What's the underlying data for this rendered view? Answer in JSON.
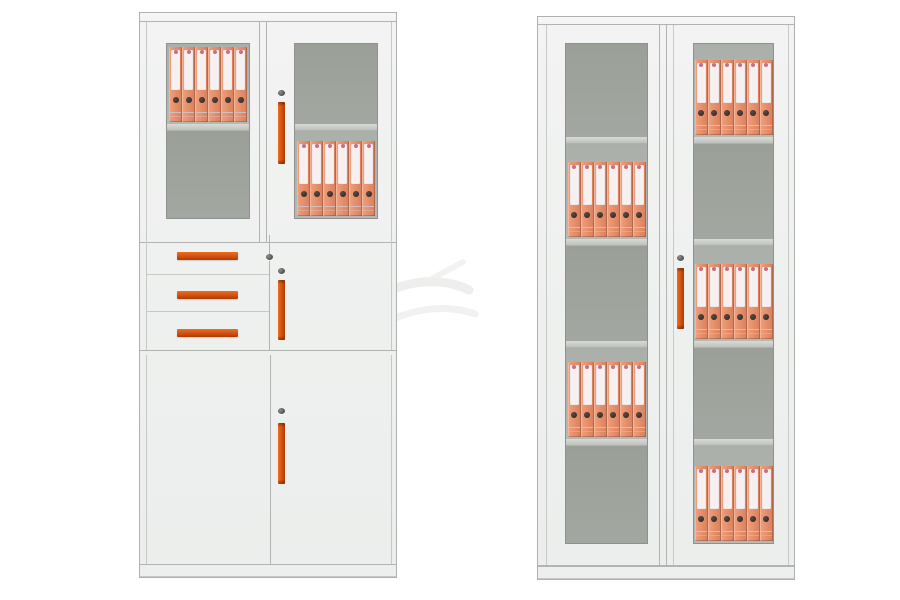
{
  "page": {
    "background": "#ffffff",
    "description_visible_text": ""
  },
  "colors": {
    "bg": "#ffffff",
    "body": "#ebeeec",
    "body_light": "#f2f3f2",
    "outer_edge": "#aeb1af",
    "frame_line": "#c7c9c8",
    "frame_dark": "#b2b4b3",
    "plinth": "#edefee",
    "glass_edge": "#8f918f",
    "glass_empty": "#a3a7a1",
    "glass_empty_top": "#9aa098",
    "glass_filled": "#b6b9b3",
    "glass_filled_top": "#abafa9",
    "shelf_light": "#d8dad6",
    "shelf_dark": "#bec1bc",
    "handle": "#d14d0b",
    "handle_hi": "#ec6d1f",
    "handle_lo": "#a83d06",
    "lock": "#484848",
    "binder_spine": "#e58d69",
    "binder_hi": "#f0a07d",
    "binder_lo": "#d87e5b",
    "binder_label": "#f7f0f0",
    "binder_dot": "#c76f86",
    "binder_text": "#cfbfc1",
    "binder_hole": "#362d29",
    "watermark": "#ebebea"
  },
  "left_cabinet": {
    "type": "filing cabinet with glass upper doors, three drawers and lower doors",
    "upper": {
      "left_glass": {
        "compartments": [
          {
            "h": 81,
            "binders": 6
          },
          {
            "h": 88,
            "binders": 0
          }
        ]
      },
      "right_glass": {
        "compartments": [
          {
            "h": 81,
            "binders": 0
          },
          {
            "h": 88,
            "binders": 6
          }
        ]
      },
      "lock": true,
      "handle": true
    },
    "middle": {
      "drawers": 3,
      "drawer_handles": 3,
      "drawer_lock": true,
      "door_lock": true,
      "door_handle": true
    },
    "lower": {
      "doors": 2,
      "lock": true,
      "handle": true
    }
  },
  "right_cabinet": {
    "type": "tall two-door glass-front cabinet with five shelves",
    "left_door": {
      "compartments": [
        {
          "h": 93,
          "binders": 0
        },
        {
          "h": 96,
          "binders": 6
        },
        {
          "h": 95,
          "binders": 0
        },
        {
          "h": 92,
          "binders": 6
        },
        {
          "h": 97,
          "binders": 0
        }
      ]
    },
    "right_door": {
      "compartments": [
        {
          "h": 93,
          "binders": 6
        },
        {
          "h": 96,
          "binders": 0
        },
        {
          "h": 95,
          "binders": 6
        },
        {
          "h": 92,
          "binders": 0
        },
        {
          "h": 97,
          "binders": 6
        }
      ]
    },
    "lock": true,
    "handle": true
  },
  "watermark": {
    "visible": true
  }
}
